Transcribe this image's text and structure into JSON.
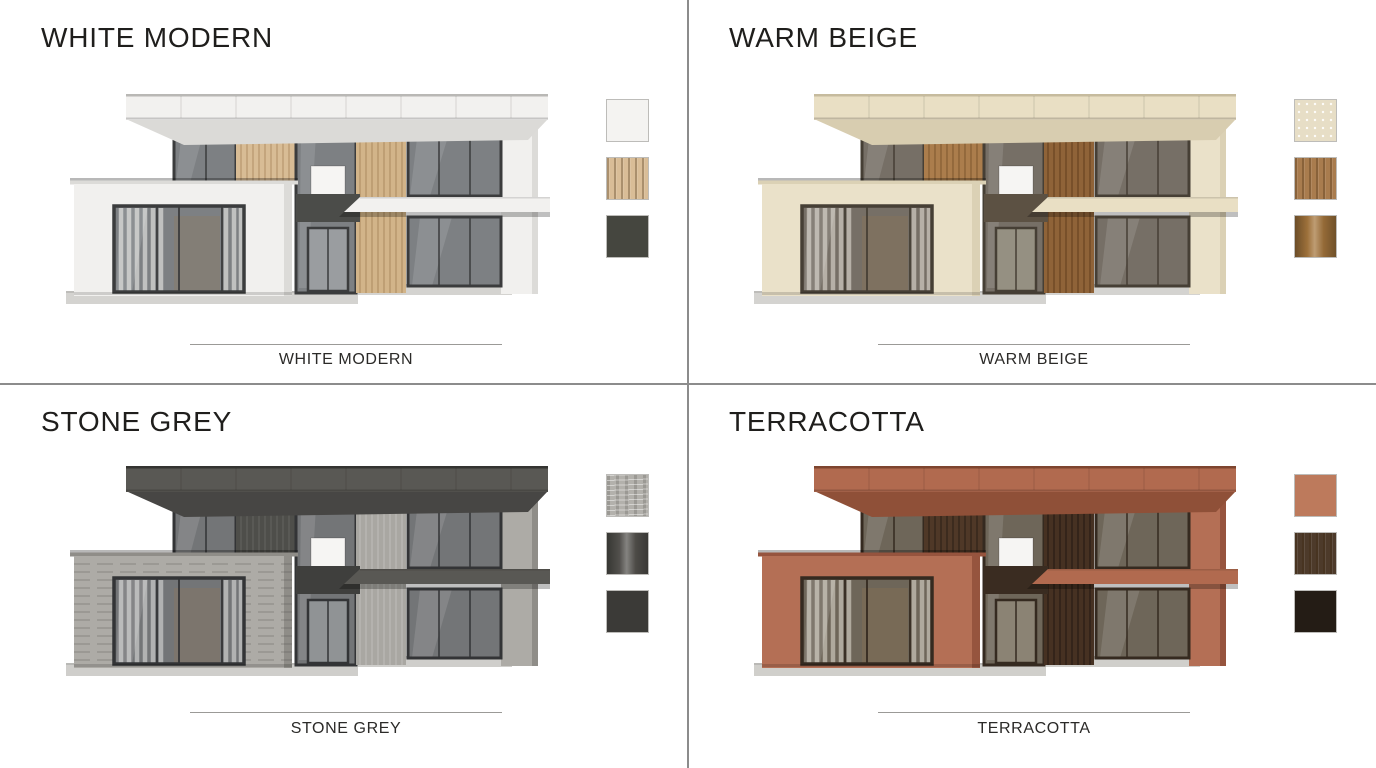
{
  "board": {
    "background": "#ffffff",
    "divider_color": "#8c8c8c"
  },
  "variants": [
    {
      "id": "white-modern",
      "title": "WHITE MODERN",
      "caption": "WHITE MODERN",
      "palette": {
        "roof": "#f2f1ef",
        "roofline": "#b9b8b5",
        "soffit": "#dbdad7",
        "wall": "#f1f0ee",
        "wallshade": "#dcdbd8",
        "panela": "#d8bc95",
        "graina": "rgba(130,90,45,0.35)",
        "panelb": "#d2b489",
        "grainb": "rgba(130,90,45,0.35)",
        "glass": "#7d8083",
        "glasshi": "#9a9da0",
        "frame": "#3b3c3d",
        "dark": "#4b4c49",
        "plinth": "#d4d3d0",
        "curtain": "rgba(248,246,242,0.55)",
        "texline": "rgba(0,0,0,0)"
      },
      "swatches": [
        {
          "role": "facade",
          "hex": "#f4f3f1",
          "texture": "flat"
        },
        {
          "role": "wood",
          "hex": "#d9bd97",
          "texture": "wood"
        },
        {
          "role": "accent",
          "hex": "#45463f",
          "texture": "flat"
        }
      ]
    },
    {
      "id": "warm-beige",
      "title": "WARM BEIGE",
      "caption": "WARM BEIGE",
      "palette": {
        "roof": "#e9dfc4",
        "roofline": "#c6bb9e",
        "soffit": "#d8cdb0",
        "wall": "#eae1c9",
        "wallshade": "#dbd1b5",
        "panela": "#ab7d4c",
        "graina": "rgba(70,40,12,0.35)",
        "panelb": "#8f6338",
        "grainb": "rgba(55,30,8,0.40)",
        "glass": "#766f66",
        "glasshi": "#959082",
        "frame": "#463f35",
        "dark": "#5c5143",
        "plinth": "#d4d3d0",
        "curtain": "rgba(246,241,231,0.50)",
        "texline": "rgba(0,0,0,0)"
      },
      "swatches": [
        {
          "role": "facade",
          "hex": "#e7dec6",
          "texture": "speckle"
        },
        {
          "role": "wood",
          "hex": "#a97c4e",
          "texture": "wood"
        },
        {
          "role": "accent",
          "hex": "#a5763d",
          "texture": "sheen"
        }
      ]
    },
    {
      "id": "stone-grey",
      "title": "STONE GREY",
      "caption": "STONE GREY",
      "palette": {
        "roof": "#595854",
        "roofline": "#343431",
        "soffit": "#474644",
        "wall": "#adaba6",
        "wallshade": "#8f8d88",
        "panela": "#4e4e4a",
        "graina": "rgba(255,255,255,0.10)",
        "panelb": "#a9a7a2",
        "grainb": "rgba(255,255,255,0.20)",
        "glass": "#737577",
        "glasshi": "#909395",
        "frame": "#333436",
        "dark": "#3f3f3d",
        "plinth": "#cfcecb",
        "curtain": "rgba(240,240,238,0.50)",
        "texline": "rgba(72,70,66,0.35)"
      },
      "swatches": [
        {
          "role": "facade",
          "hex": "#b3b1ac",
          "texture": "stone"
        },
        {
          "role": "wood",
          "hex": "#55534f",
          "texture": "sheen"
        },
        {
          "role": "accent",
          "hex": "#3b3a37",
          "texture": "flat"
        }
      ]
    },
    {
      "id": "terracotta",
      "title": "TERRACOTTA",
      "caption": "TERRACOTTA",
      "palette": {
        "roof": "#b16a4f",
        "roofline": "#7e452f",
        "soffit": "#8f5038",
        "wall": "#b46f55",
        "wallshade": "#96543e",
        "panela": "#4f3827",
        "graina": "rgba(0,0,0,0.35)",
        "panelb": "#463122",
        "grainb": "rgba(0,0,0,0.38)",
        "glass": "#6e6659",
        "glasshi": "#8b8374",
        "frame": "#352a20",
        "dark": "#3a2c21",
        "plinth": "#d0cfcb",
        "curtain": "rgba(240,235,225,0.50)",
        "texline": "rgba(0,0,0,0)"
      },
      "swatches": [
        {
          "role": "facade",
          "hex": "#bd7a5c",
          "texture": "flat"
        },
        {
          "role": "wood",
          "hex": "#4d3a2a",
          "texture": "wood"
        },
        {
          "role": "accent",
          "hex": "#241c15",
          "texture": "flat"
        }
      ]
    }
  ]
}
